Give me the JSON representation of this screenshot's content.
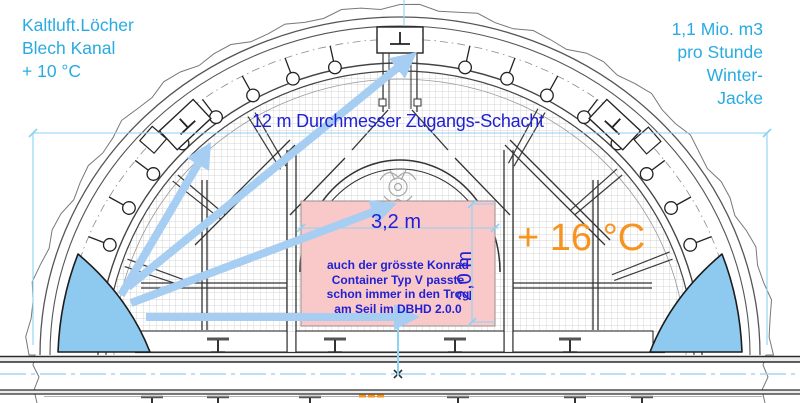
{
  "notes": {
    "cold_air": {
      "lines": [
        "Kaltluft.Löcher",
        "Blech Kanal",
        "+ 10 °C"
      ]
    },
    "airflow": {
      "lines": [
        "1,1 Mio. m3",
        "pro Stunde",
        "Winter-",
        "Jacke"
      ]
    }
  },
  "labels": {
    "shaft": "12 m Durchmesser Zugangs-Schacht",
    "temp_inside": "+ 16 °C",
    "trough_width": "3,2 m",
    "trough_height": "2,0 m"
  },
  "container_note": {
    "lines": [
      "auch der grösste Konrad",
      "Container Typ V passte",
      "schon immer in den Trog",
      "am Seil im DBHD 2.0.0"
    ]
  },
  "colors": {
    "cyan": "#29abe2",
    "blue": "#2121d2",
    "orange": "#f7941e",
    "pink_fill": "#f9c8c9",
    "arrow_blue": "#a6cdf2",
    "duct_blue": "#8ec9ef",
    "dim_cyan": "#8ed2f4"
  }
}
